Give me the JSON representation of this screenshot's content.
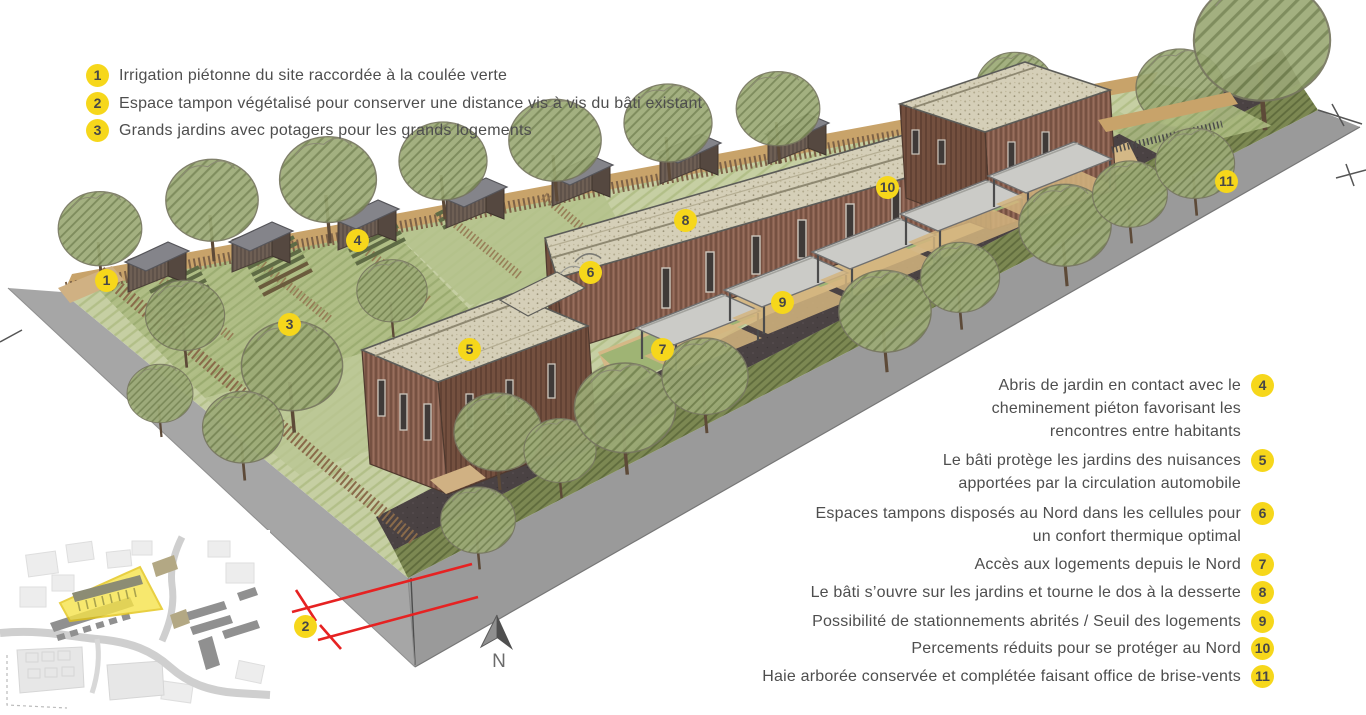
{
  "legend_left": {
    "items": [
      {
        "number": "1",
        "text": "Irrigation piétonne du site raccordée à la coulée verte"
      },
      {
        "number": "2",
        "text": "Espace tampon végétalisé pour conserver une distance vis à vis du bâti existant"
      },
      {
        "number": "3",
        "text": "Grands jardins avec potagers pour les grands logements"
      }
    ]
  },
  "legend_right": {
    "items": [
      {
        "number": "4",
        "lines": [
          "Abris de jardin en contact avec le",
          "cheminement  piéton favorisant les",
          "rencontres entre habitants"
        ]
      },
      {
        "number": "5",
        "lines": [
          "Le bâti protège les jardins des nuisances",
          "apportées par la circulation automobile"
        ]
      },
      {
        "number": "6",
        "lines": [
          "Espaces tampons disposés au Nord dans les cellules pour",
          "un confort thermique optimal"
        ]
      },
      {
        "number": "7",
        "lines": [
          "Accès aux logements depuis le Nord"
        ]
      },
      {
        "number": "8",
        "lines": [
          "Le bâti s’ouvre sur les jardins et tourne le dos à la desserte"
        ]
      },
      {
        "number": "9",
        "lines": [
          "Possibilité de stationnements abrités / Seuil des logements"
        ]
      },
      {
        "number": "10",
        "lines": [
          "Percements réduits pour se protéger au Nord"
        ]
      },
      {
        "number": "11",
        "lines": [
          "Haie arborée conservée et complétée faisant office de brise-vents"
        ]
      }
    ]
  },
  "markers": [
    "1",
    "2",
    "3",
    "4",
    "5",
    "6",
    "7",
    "8",
    "9",
    "10",
    "11"
  ],
  "compass": {
    "label": "N"
  },
  "colors": {
    "badge_yellow": "#f6d71b",
    "annotation_red": "#e62222",
    "site_highlight_yellow": "#f6e34a",
    "legend_text_gray": "#4e4e4e"
  }
}
